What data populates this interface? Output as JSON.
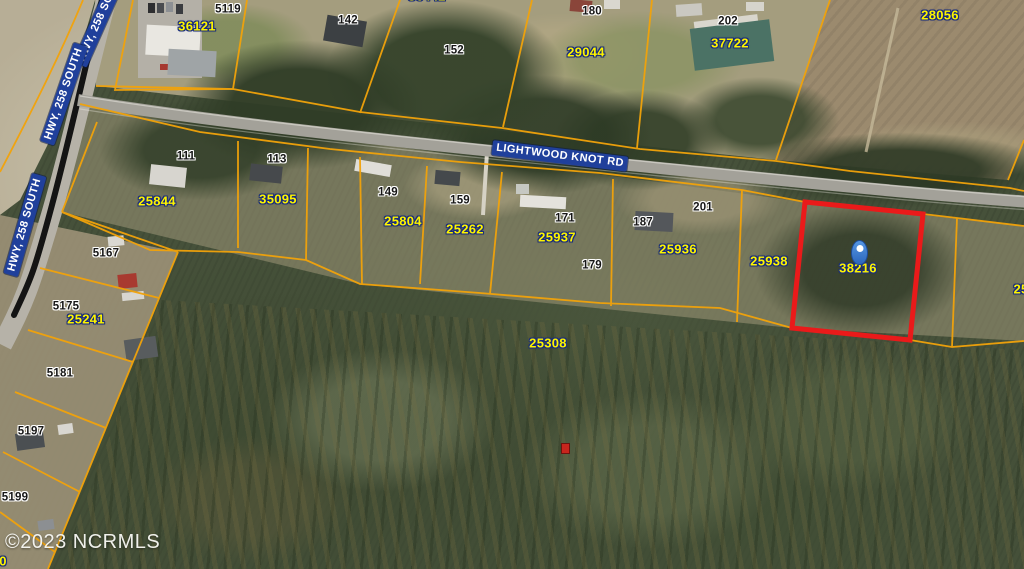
{
  "map": {
    "provider_watermark": "©2023 NCRMLS",
    "road_labels": {
      "lightwood": "LIGHTWOOD KNOT RD",
      "hwy258": "HWY, 258 SOUTH"
    },
    "selected_listing": {
      "mls_number": "38216",
      "outline_color": "#ea1a1a",
      "pin_color": "#3a7fd6"
    },
    "mls_numbers": [
      "36121",
      "36442",
      "29044",
      "37722",
      "28056",
      "25844",
      "35095",
      "25804",
      "25262",
      "25937",
      "25936",
      "25938",
      "25308",
      "25241",
      "25",
      "0"
    ],
    "house_numbers": [
      "5119",
      "142",
      "152",
      "180",
      "202",
      "111",
      "113",
      "149",
      "159",
      "171",
      "179",
      "187",
      "201",
      "5167",
      "5175",
      "5181",
      "5197",
      "5199"
    ],
    "colors": {
      "parcel_line": "#f2a30a",
      "mls_text": "#fdf400",
      "mls_halo": "#1a2d7c",
      "house_number_text": "#161616",
      "road_label_bg": "#20409b",
      "road_label_text": "#ffffff"
    }
  }
}
